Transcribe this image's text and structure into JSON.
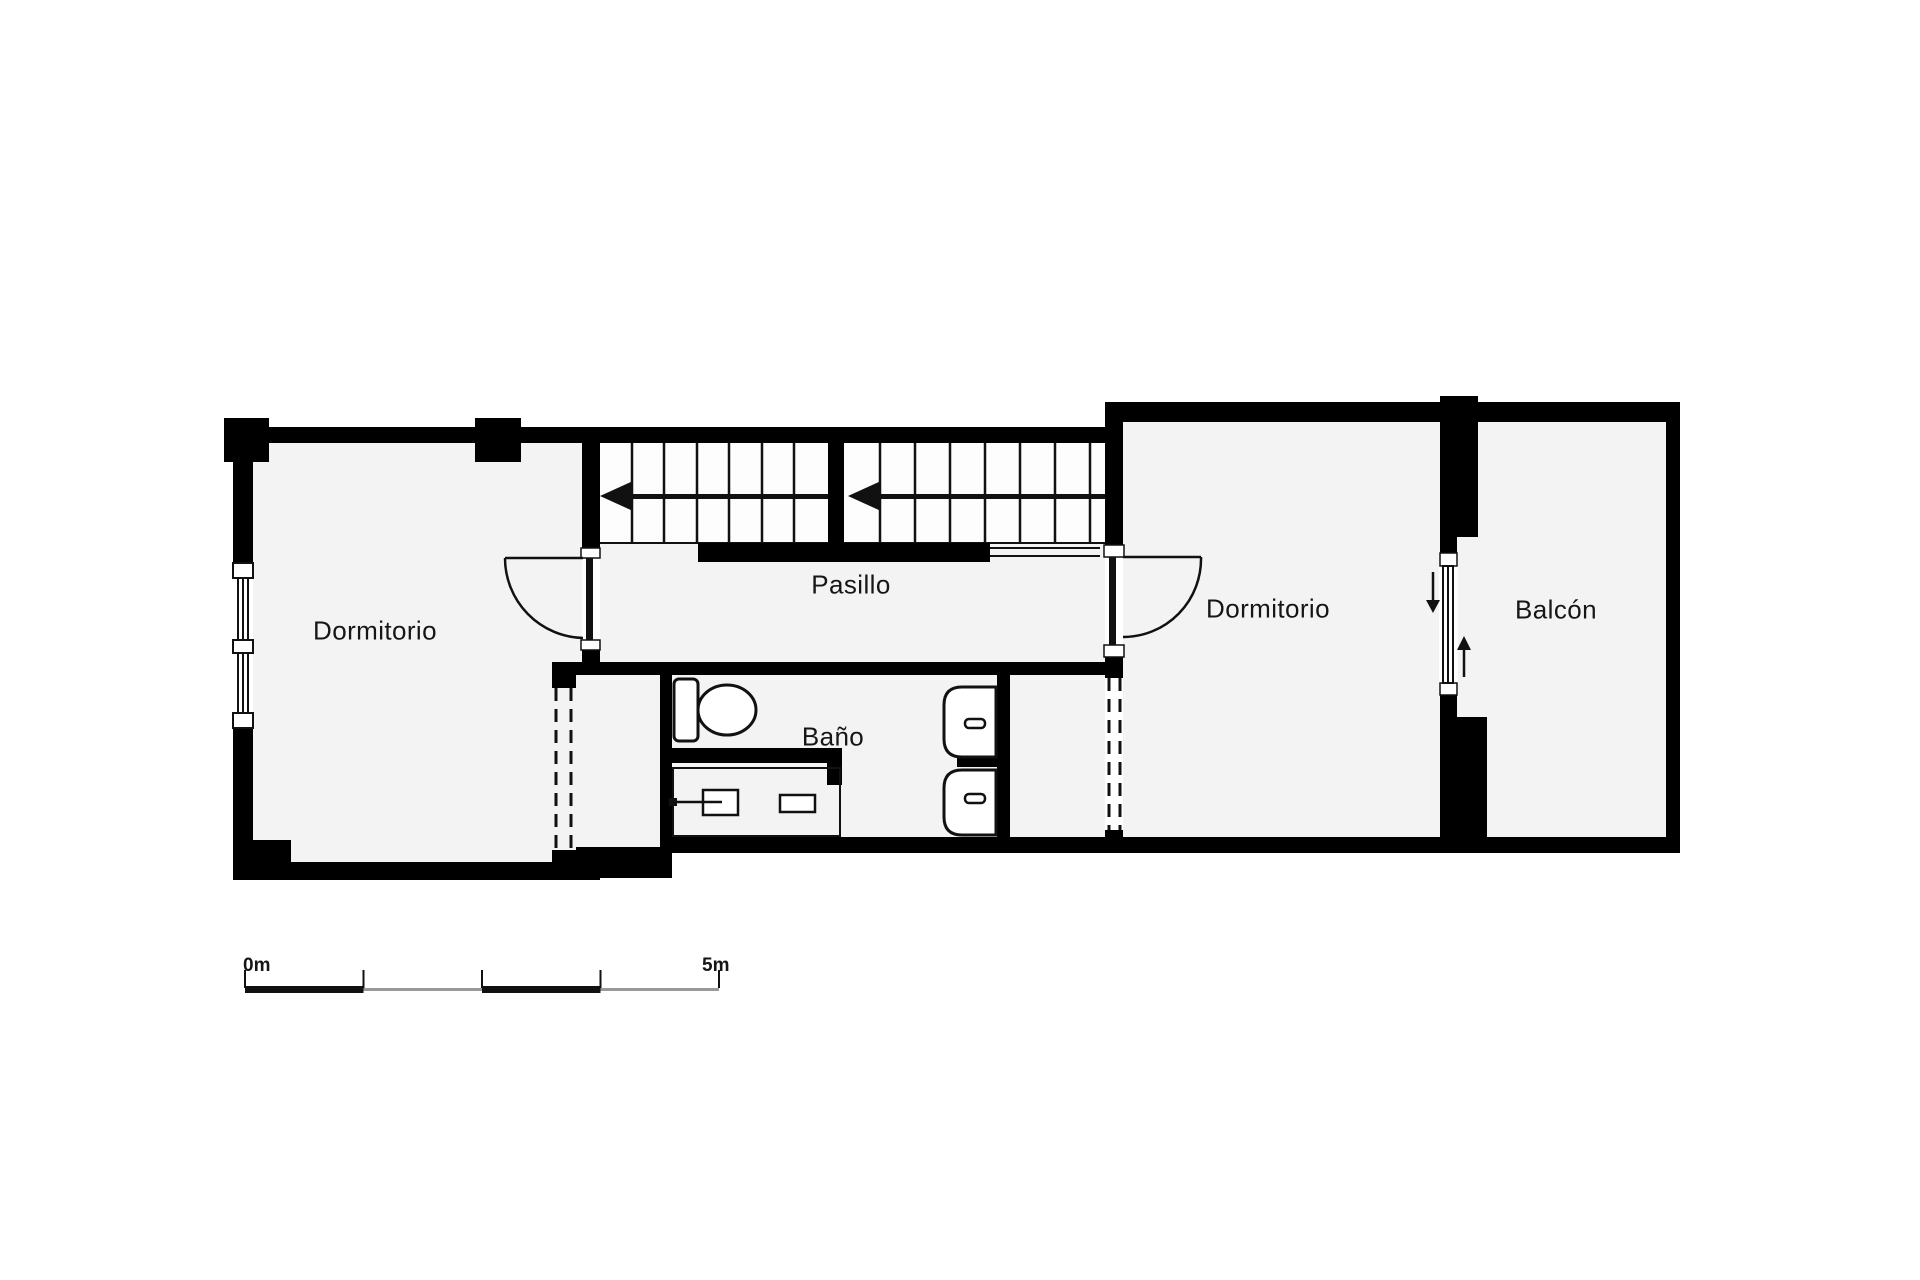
{
  "plan": {
    "rooms": [
      {
        "id": "dormitorio-left",
        "label": "Dormitorio"
      },
      {
        "id": "pasillo",
        "label": "Pasillo"
      },
      {
        "id": "bano",
        "label": "Baño"
      },
      {
        "id": "dormitorio-right",
        "label": "Dormitorio"
      },
      {
        "id": "balcon",
        "label": "Balcón"
      }
    ],
    "scale_bar": {
      "start_label": "0m",
      "end_label": "5m"
    },
    "colors": {
      "wall": "#000000",
      "floor": "#f3f3f3",
      "tread": "#fdfdfd",
      "background": "#ffffff",
      "line": "#111111",
      "scale_gray": "#999999"
    }
  }
}
